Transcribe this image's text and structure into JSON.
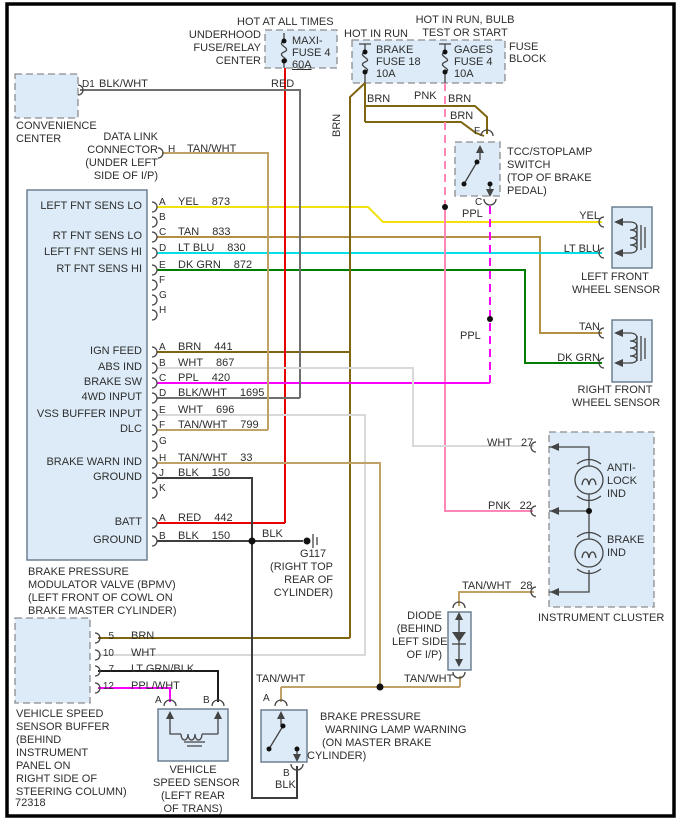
{
  "colors": {
    "yel": "#f2e10c",
    "tan": "#b18f45",
    "tan_wht": "#c0a267",
    "brn": "#7f650f",
    "lt_blu": "#00dfe8",
    "dk_grn": "#007d00",
    "ppl": "#fb00fb",
    "pnk": "#ff86b6",
    "red": "#e80000",
    "wht": "#d9d9d9",
    "blk": "#3d3d3d",
    "blk_wht": "#6f6f6f",
    "lt_grn_blk": "#1c1c1c",
    "ppl_wht": "#fb00fb",
    "sym": "#444444",
    "box_fill": "#dcebf7",
    "box_solid": "#64788c",
    "box_dash": "#8c8c8c",
    "text": "#2e2e2e"
  },
  "top": {
    "hot_at_all_times": "HOT AT ALL TIMES",
    "underhood": [
      "UNDERHOOD",
      "FUSE/RELAY",
      "CENTER"
    ],
    "maxi": [
      "MAXI-",
      "FUSE 4",
      "60A"
    ],
    "red_label": "RED",
    "hot_in_run": "HOT IN RUN",
    "hot_in_run_bulb": [
      "HOT IN RUN, BULB",
      "TEST OR START"
    ],
    "brake_fuse": [
      "BRAKE",
      "FUSE 18",
      "10A"
    ],
    "gages_fuse": [
      "GAGES",
      "FUSE 4",
      "10A"
    ],
    "fuse_block": [
      "FUSE",
      "BLOCK"
    ],
    "wire_tags": {
      "brn1": "BRN",
      "pnk": "PNK",
      "brn2": "BRN",
      "brn3": "BRN",
      "brn_vertical": "BRN"
    }
  },
  "convenience": {
    "caption": [
      "CONVENIENCE",
      "CENTER"
    ],
    "pin": "D1",
    "wire": "BLK/WHT"
  },
  "dlc": {
    "caption": [
      "DATA LINK",
      "CONNECTOR",
      "(UNDER LEFT",
      "SIDE OF I/P)"
    ],
    "pin": "H",
    "wire": "TAN/WHT"
  },
  "tcc": {
    "caption": [
      "TCC/STOPLAMP",
      "SWITCH",
      "(TOP OF BRAKE",
      "PEDAL)"
    ],
    "pin_top": "F",
    "pin_bottom": "C",
    "ppl1": "PPL",
    "ppl2": "PPL"
  },
  "bpmv": {
    "g1": [
      {
        "letter": "A",
        "label": "LEFT FNT SENS LO",
        "color": "YEL",
        "circuit": "873"
      },
      {
        "letter": "B"
      },
      {
        "letter": "C",
        "label": "RT FNT SENS LO",
        "color": "TAN",
        "circuit": "833"
      },
      {
        "letter": "D",
        "label": "LEFT FNT SENS HI",
        "color": "LT BLU",
        "circuit": "830"
      },
      {
        "letter": "E",
        "label": "RT FNT SENS HI",
        "color": "DK GRN",
        "circuit": "872"
      },
      {
        "letter": "F"
      },
      {
        "letter": "G"
      },
      {
        "letter": "H"
      }
    ],
    "g2": [
      {
        "letter": "A",
        "label": "IGN FEED",
        "color": "BRN",
        "circuit": "441"
      },
      {
        "letter": "B",
        "label": "ABS IND",
        "color": "WHT",
        "circuit": "867"
      },
      {
        "letter": "C",
        "label": "BRAKE SW",
        "color": "PPL",
        "circuit": "420"
      },
      {
        "letter": "D",
        "label": "4WD INPUT",
        "color": "BLK/WHT",
        "circuit": "1695"
      },
      {
        "letter": "E",
        "label": "VSS BUFFER INPUT",
        "color": "WHT",
        "circuit": "696"
      },
      {
        "letter": "F",
        "label": "DLC",
        "color": "TAN/WHT",
        "circuit": "799"
      },
      {
        "letter": "G"
      },
      {
        "letter": "H",
        "label": "BRAKE WARN IND",
        "color": "TAN/WHT",
        "circuit": "33"
      },
      {
        "letter": "J",
        "label": "GROUND",
        "color": "BLK",
        "circuit": "150"
      },
      {
        "letter": "K"
      }
    ],
    "g3": [
      {
        "letter": "A",
        "label": "BATT",
        "color": "RED",
        "circuit": "442"
      },
      {
        "letter": "B",
        "label": "GROUND",
        "color": "BLK",
        "circuit": "150"
      }
    ],
    "caption": [
      "BRAKE PRESSURE",
      "MODULATOR VALVE (BPMV)",
      "(LEFT FRONT OF COWL ON",
      "BRAKE MASTER CYLINDER)"
    ]
  },
  "g117": {
    "wire": "BLK",
    "name": "G117",
    "caption": [
      "(RIGHT TOP",
      "REAR OF",
      "CYLINDER)"
    ]
  },
  "sensors": {
    "lf": {
      "pin1": "YEL",
      "pin2": "LT BLU",
      "caption": [
        "LEFT FRONT",
        "WHEEL SENSOR"
      ]
    },
    "rf": {
      "pin1": "TAN",
      "pin2": "DK GRN",
      "caption": [
        "RIGHT FRONT",
        "WHEEL SENSOR"
      ]
    }
  },
  "cluster": {
    "pin27": {
      "color": "WHT",
      "num": "27"
    },
    "pin22": {
      "color": "PNK",
      "num": "22"
    },
    "pin28": {
      "color": "TAN/WHT",
      "num": "28"
    },
    "lamp1": [
      "ANTI-",
      "LOCK",
      "IND"
    ],
    "lamp2": [
      "BRAKE",
      "IND"
    ],
    "caption": "INSTRUMENT CLUSTER"
  },
  "diode": {
    "caption": [
      "DIODE",
      "(BEHIND",
      "LEFT SIDE",
      "OF I/P)"
    ]
  },
  "splice": {
    "left": "TAN/WHT",
    "right": "TAN/WHT"
  },
  "buffer": {
    "pins": [
      {
        "num": "5",
        "color": "BRN"
      },
      {
        "num": "10",
        "color": "WHT"
      },
      {
        "num": "7",
        "color": "LT GRN/BLK"
      },
      {
        "num": "12",
        "color": "PPL/WHT"
      }
    ],
    "caption": [
      "VEHICLE SPEED",
      "SENSOR BUFFER",
      "(BEHIND",
      "INSTRUMENT",
      "PANEL ON",
      "RIGHT SIDE OF",
      "STEERING COLUMN)"
    ]
  },
  "vss": {
    "pin_a": "A",
    "pin_b": "B",
    "caption": [
      "VEHICLE",
      "SPEED SENSOR",
      "(LEFT REAR",
      "OF TRANS)"
    ]
  },
  "bpw": {
    "pin_a": "A",
    "pin_b": "B",
    "wire_b": "BLK",
    "caption": [
      "BRAKE PRESSURE",
      "WARNING LAMP WARNING",
      "(ON MASTER BRAKE",
      "CYLINDER)"
    ]
  },
  "doc_number": "72318"
}
